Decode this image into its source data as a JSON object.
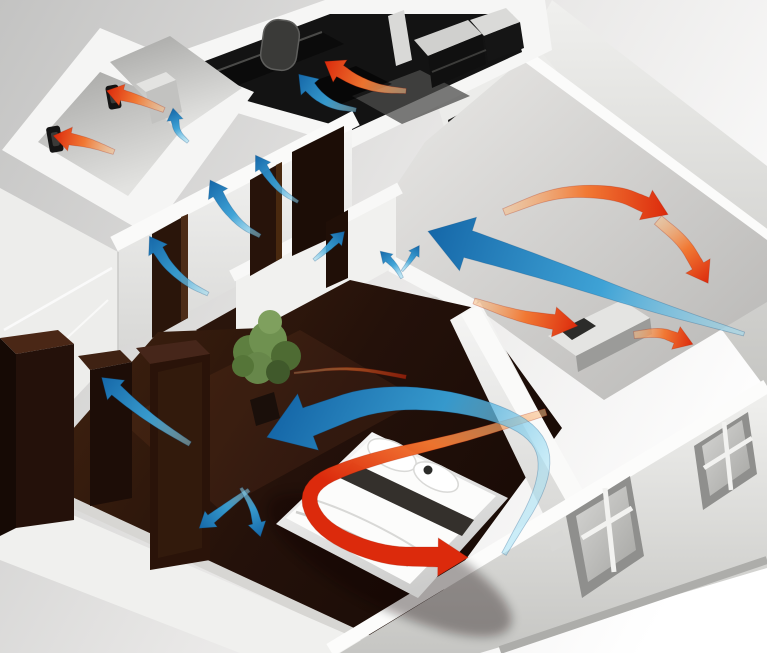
{
  "scene": {
    "kind": "3d-cutaway-apartment-ventilation-illustration",
    "description": "Isometric 3D cutaway of an apartment showing ventilation airflow: blue supply-air arrows flow through living room, bedroom and hallway door undercuts; red exhaust-air arrows are extracted in kitchen, bathroom and WC wall fans.",
    "width": 767,
    "height": 653
  },
  "palette": {
    "background_top_left": "#c3c3c2",
    "background_bottom_right": "#ffffff",
    "wall_white": "#f7f7f6",
    "wall_shadow": "#d6d5d3",
    "floor_dark_wood": "#2a150c",
    "kitchen_dark": "#131313",
    "bath_gray": "#b5b5b3",
    "plant_green": "#6f9150",
    "supply_air_head": "#1567a8",
    "supply_air_mid": "#37a0d6",
    "supply_air_tail": "#9adef5",
    "exhaust_air_head": "#dc2a0c",
    "exhaust_air_mid": "#f2762f",
    "exhaust_air_tail": "#f9c089"
  },
  "rooms": [
    {
      "name": "bathroom",
      "feature": "wall exhaust fan"
    },
    {
      "name": "wc",
      "feature": "wall exhaust fan"
    },
    {
      "name": "kitchen",
      "feature": "dark cabinets, exhaust above counter"
    },
    {
      "name": "hallway",
      "feature": "door transfer airflow"
    },
    {
      "name": "living-room",
      "feature": "large supply and exhaust loop"
    },
    {
      "name": "bedroom",
      "feature": "double bed, wardrobes, plant"
    }
  ],
  "equipment": {
    "exhaust_fans": [
      {
        "room": "bathroom",
        "x": 52,
        "y": 130
      },
      {
        "room": "wc",
        "x": 110,
        "y": 88
      }
    ],
    "windows": [
      {
        "wall": "front-exterior",
        "cx": 608,
        "cy": 538
      },
      {
        "wall": "front-exterior",
        "cx": 724,
        "cy": 458
      },
      {
        "wall": "kitchen-side",
        "cx": 468,
        "cy": 140
      }
    ]
  },
  "airflow": {
    "arrows": [
      {
        "id": "exhaust-bedroom-tail",
        "kind": "exhaust",
        "pts": [
          [
            294,
            373
          ],
          [
            350,
            367
          ],
          [
            406,
            377
          ]
        ],
        "w0": 2,
        "w1": 4,
        "hl": 0,
        "hw": 0,
        "op": 0.55
      },
      {
        "id": "exhaust-bedroom-loop",
        "kind": "exhaust",
        "pts": [
          [
            546,
            412
          ],
          [
            462,
            438
          ],
          [
            366,
            460
          ],
          [
            304,
            486
          ],
          [
            318,
            528
          ],
          [
            380,
            556
          ],
          [
            438,
            557
          ]
        ],
        "w0": 7,
        "w1": 20,
        "hl": 30,
        "hw": 19
      },
      {
        "id": "supply-bedroom-main",
        "kind": "supply",
        "pts": [
          [
            504,
            554
          ],
          [
            548,
            478
          ],
          [
            538,
            430
          ],
          [
            466,
            402
          ],
          [
            378,
            396
          ],
          [
            308,
            422
          ]
        ],
        "w0": 5,
        "w1": 30,
        "hl": 44,
        "hw": 30
      },
      {
        "id": "supply-living-main",
        "kind": "supply",
        "pts": [
          [
            744,
            334
          ],
          [
            652,
            306
          ],
          [
            556,
            272
          ],
          [
            468,
            244
          ]
        ],
        "w0": 4,
        "w1": 28,
        "hl": 42,
        "hw": 28
      },
      {
        "id": "supply-hall-door-1",
        "kind": "supply",
        "pts": [
          [
            208,
            294
          ],
          [
            188,
            284
          ],
          [
            168,
            266
          ],
          [
            158,
            250
          ]
        ],
        "w0": 4,
        "w1": 11,
        "hl": 16,
        "hw": 11
      },
      {
        "id": "supply-hall-door-2",
        "kind": "supply",
        "pts": [
          [
            260,
            236
          ],
          [
            242,
            226
          ],
          [
            226,
            208
          ],
          [
            218,
            194
          ]
        ],
        "w0": 4,
        "w1": 11,
        "hl": 16,
        "hw": 11
      },
      {
        "id": "supply-hall-door-3",
        "kind": "supply",
        "pts": [
          [
            298,
            202
          ],
          [
            282,
            192
          ],
          [
            270,
            178
          ],
          [
            263,
            167
          ]
        ],
        "w0": 3,
        "w1": 9,
        "hl": 14,
        "hw": 9
      },
      {
        "id": "supply-hall-door-4",
        "kind": "supply",
        "pts": [
          [
            314,
            260
          ],
          [
            326,
            250
          ],
          [
            336,
            240
          ]
        ],
        "w0": 3,
        "w1": 8,
        "hl": 12,
        "hw": 8
      },
      {
        "id": "supply-bath-transfer",
        "kind": "supply",
        "pts": [
          [
            188,
            142
          ],
          [
            177,
            132
          ],
          [
            175,
            120
          ]
        ],
        "w0": 3,
        "w1": 8,
        "hl": 12,
        "hw": 8
      },
      {
        "id": "supply-kitchen",
        "kind": "supply",
        "pts": [
          [
            356,
            110
          ],
          [
            334,
            106
          ],
          [
            318,
            96
          ],
          [
            310,
            87
          ]
        ],
        "w0": 4,
        "w1": 12,
        "hl": 17,
        "hw": 12
      },
      {
        "id": "supply-under-door",
        "kind": "supply",
        "pts": [
          [
            190,
            444
          ],
          [
            158,
            424
          ],
          [
            132,
            404
          ],
          [
            116,
            390
          ]
        ],
        "w0": 5,
        "w1": 13,
        "hl": 19,
        "hw": 13
      },
      {
        "id": "supply-bedroom-split-left",
        "kind": "supply",
        "pts": [
          [
            249,
            490
          ],
          [
            229,
            505
          ],
          [
            211,
            519
          ]
        ],
        "w0": 4,
        "w1": 10,
        "hl": 15,
        "hw": 10
      },
      {
        "id": "supply-bedroom-split-right",
        "kind": "supply",
        "pts": [
          [
            241,
            488
          ],
          [
            253,
            507
          ],
          [
            257,
            523
          ]
        ],
        "w0": 3,
        "w1": 9,
        "hl": 14,
        "hw": 9
      },
      {
        "id": "supply-living-sprout-a",
        "kind": "supply",
        "pts": [
          [
            402,
            278
          ],
          [
            396,
            267
          ],
          [
            388,
            259
          ]
        ],
        "w0": 3,
        "w1": 7,
        "hl": 11,
        "hw": 7
      },
      {
        "id": "supply-living-sprout-b",
        "kind": "supply",
        "pts": [
          [
            402,
            271
          ],
          [
            409,
            262
          ],
          [
            414,
            254
          ]
        ],
        "w0": 2,
        "w1": 6,
        "hl": 10,
        "hw": 6
      },
      {
        "id": "exhaust-bathroom-fan",
        "kind": "exhaust",
        "pts": [
          [
            114,
            152
          ],
          [
            90,
            143
          ],
          [
            70,
            139
          ]
        ],
        "w0": 5,
        "w1": 12,
        "hl": 17,
        "hw": 12
      },
      {
        "id": "exhaust-wc-fan",
        "kind": "exhaust",
        "pts": [
          [
            164,
            110
          ],
          [
            140,
            100
          ],
          [
            122,
            95
          ]
        ],
        "w0": 5,
        "w1": 11,
        "hl": 16,
        "hw": 11
      },
      {
        "id": "exhaust-kitchen-hood",
        "kind": "exhaust",
        "pts": [
          [
            406,
            91
          ],
          [
            380,
            89
          ],
          [
            356,
            81
          ],
          [
            340,
            71
          ]
        ],
        "w0": 5,
        "w1": 13,
        "hl": 18,
        "hw": 13
      },
      {
        "id": "exhaust-living-top",
        "kind": "exhaust",
        "pts": [
          [
            504,
            212
          ],
          [
            558,
            191
          ],
          [
            616,
            192
          ],
          [
            646,
            205
          ]
        ],
        "w0": 7,
        "w1": 16,
        "hl": 24,
        "hw": 16
      },
      {
        "id": "exhaust-living-drop",
        "kind": "exhaust",
        "pts": [
          [
            658,
            220
          ],
          [
            684,
            242
          ],
          [
            698,
            266
          ]
        ],
        "w0": 11,
        "w1": 13,
        "hl": 20,
        "hw": 14
      },
      {
        "id": "exhaust-living-low",
        "kind": "exhaust",
        "pts": [
          [
            474,
            301
          ],
          [
            518,
            316
          ],
          [
            554,
            322
          ]
        ],
        "w0": 6,
        "w1": 15,
        "hl": 24,
        "hw": 15
      },
      {
        "id": "exhaust-living-exit",
        "kind": "exhaust",
        "pts": [
          [
            634,
            335
          ],
          [
            660,
            332
          ],
          [
            676,
            338
          ]
        ],
        "w0": 7,
        "w1": 11,
        "hl": 18,
        "hw": 12
      }
    ]
  }
}
